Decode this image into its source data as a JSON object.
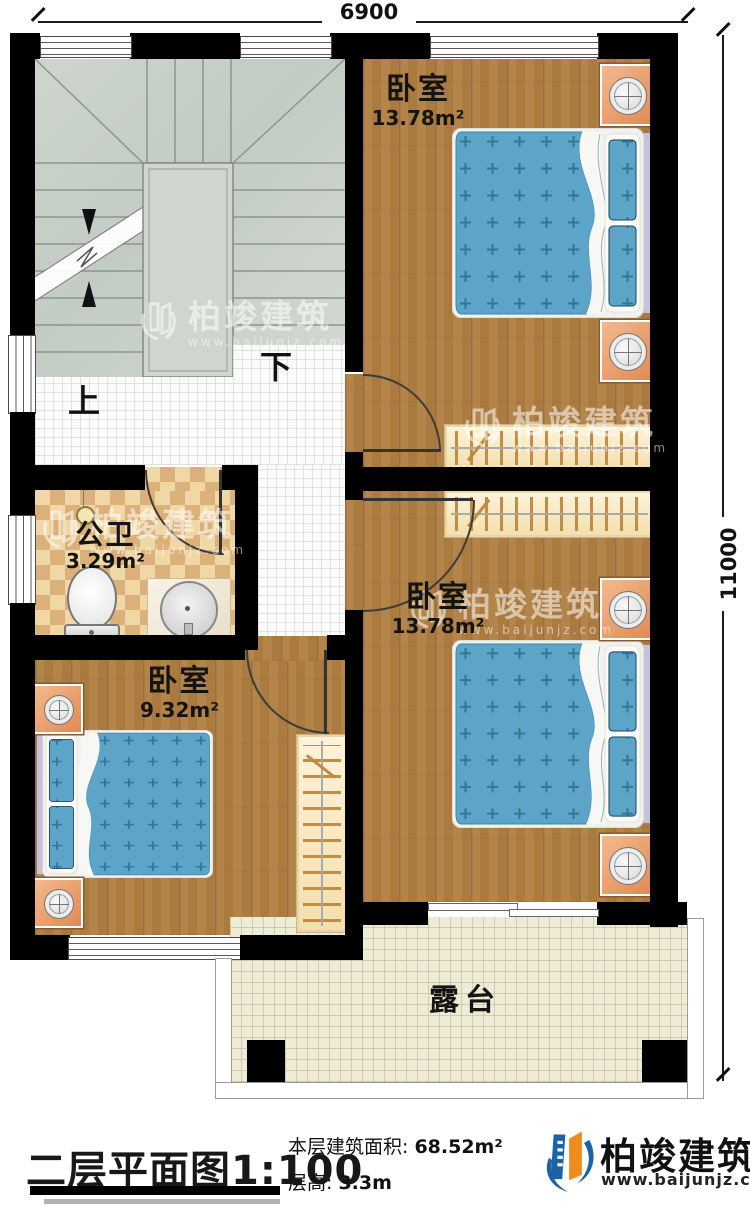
{
  "plan": {
    "dimension_top": "6900",
    "dimension_right": "11000",
    "stair_up": "上",
    "stair_down": "下"
  },
  "rooms": {
    "bedroom_top_right": {
      "name": "卧室",
      "area": "13.78m²"
    },
    "bedroom_mid_right": {
      "name": "卧室",
      "area": "13.78m²"
    },
    "bedroom_bottom_left": {
      "name": "卧室",
      "area": "9.32m²"
    },
    "bathroom": {
      "name": "公卫",
      "area": "3.29m²"
    },
    "terrace": {
      "name": "露台"
    }
  },
  "legend": {
    "title": "二层平面图",
    "scale": "1:100",
    "floor_area_label": "本层建筑面积:",
    "floor_area_value": "68.52m²",
    "floor_height_label": "层高:",
    "floor_height_value": "3.3m"
  },
  "branding": {
    "company": "柏竣建筑",
    "website": "www.baijunjz.com"
  },
  "watermark": {
    "company": "柏竣建筑",
    "website": "www.baijunjz.com"
  },
  "colors": {
    "wall": "#000000",
    "wood_floor": "#ab7a3e",
    "bed_blue": "#5ca5c8",
    "nightstand_orange": "#e8955c",
    "stair_sage": "#ccd4cb",
    "bathroom_tile": "#f0d7a6",
    "terrace_tile": "#eeebd6",
    "logo_blue": "#1b63a8",
    "logo_orange": "#f08c1e"
  }
}
